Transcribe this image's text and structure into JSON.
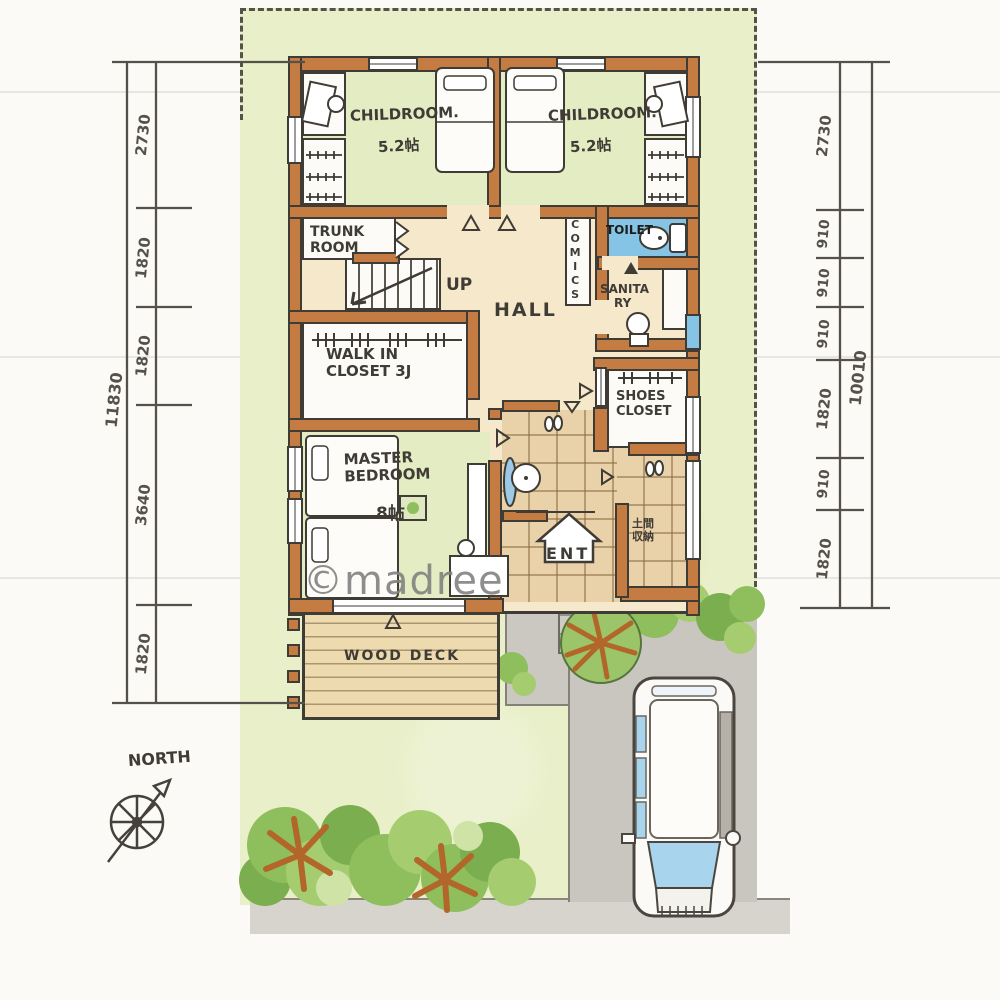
{
  "colors": {
    "ink": "#3f3b35",
    "wall": "#c57c42",
    "lawn": "#e9efc9",
    "room_green": "#e3ecc2",
    "floor": "#f6e8ca",
    "tile": "#e9d2a9",
    "toilet_blue": "#85c4e4",
    "deck": "#eddaae",
    "driveway": "#c9c6c0",
    "sidewalk": "#d6d4cd",
    "bush": "#8fbe5d",
    "branch": "#b2662a",
    "white": "#fcfbf7",
    "dim": "#55514a",
    "watermark": "#828282"
  },
  "rooms": {
    "childroom_left": {
      "name": "CHILDROOM.",
      "size": "5.2帖"
    },
    "childroom_right": {
      "name": "CHILDROOM.",
      "size": "5.2帖"
    },
    "trunk_room": {
      "line1": "TRUNK",
      "line2": "ROOM"
    },
    "stairs": {
      "label": "UP"
    },
    "hall": {
      "name": "HALL"
    },
    "comics": {
      "name": "COMICS"
    },
    "toilet": {
      "name": "TOILET"
    },
    "sanitary": {
      "line1": "SANITA",
      "line2": "RY"
    },
    "walk_in_closet": {
      "line1": "WALK IN",
      "line2": "CLOSET 3J"
    },
    "master_bedroom": {
      "line1": "MASTER",
      "line2": "BEDROOM",
      "size": "8帖"
    },
    "entrance": {
      "name": "ENT"
    },
    "shoes_closet": {
      "line1": "SHOES",
      "line2": "CLOSET"
    },
    "doma_storage": {
      "line1": "土間",
      "line2": "収納"
    },
    "wood_deck": {
      "name": "WOOD DECK"
    }
  },
  "dimensions": {
    "left": {
      "segments": [
        "2730",
        "1820",
        "1820",
        "3640",
        "1820"
      ],
      "total": "11830"
    },
    "right": {
      "segments": [
        "2730",
        "910",
        "910",
        "910",
        "1820",
        "910",
        "1820"
      ],
      "total": "10010"
    }
  },
  "compass": {
    "label": "NORTH"
  },
  "watermark": "©madree"
}
